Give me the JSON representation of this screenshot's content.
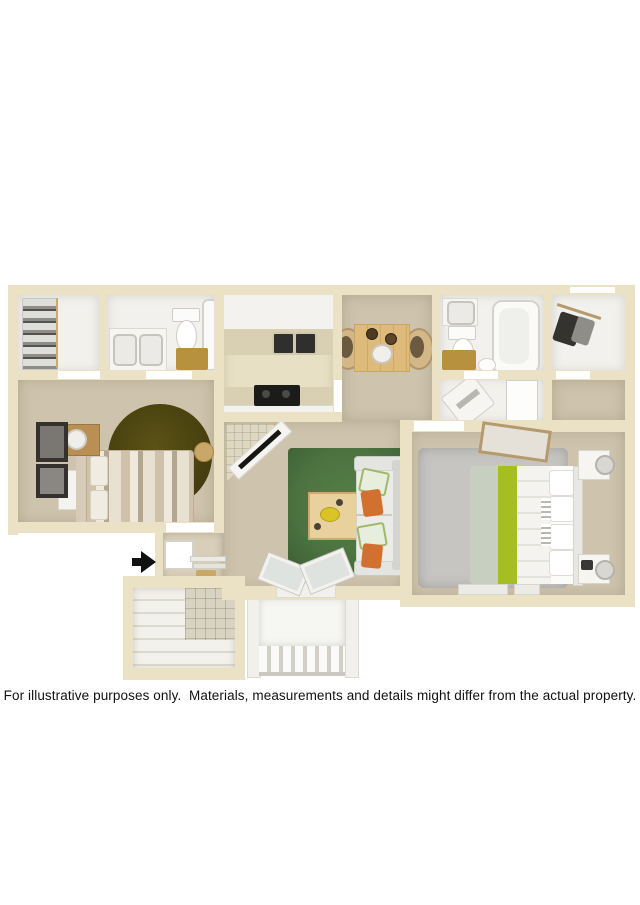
{
  "disclaimer": {
    "text": "For illustrative purposes only.  Materials, measurements and details might differ from the actual property."
  },
  "palette": {
    "wall": "#ebe2c6",
    "floor_tan": "#cec3ac",
    "floor_entry": "#d8ceba",
    "floor_tile_kitchen": "#e8e0c5",
    "floor_white": "#f2f1ed",
    "counter_beige": "#d9d0b4",
    "rug_green": "#4d7440",
    "rug_olive": "#453d0e",
    "rug_gray": "#c6c5c1",
    "bed2_chartreuse": "#a6be21",
    "bed2_sage": "#c7cfc0",
    "pillow_orange": "#d2712f",
    "wood": "#debb7b",
    "wood_dark": "#b98f54",
    "bath_gold": "#b8913f",
    "appliance_black": "#1b1b19",
    "arrow_black": "#111111",
    "text": "#111111"
  },
  "floorplan": {
    "type": "3d-rendered-floor-plan",
    "rooms": [
      {
        "name": "reach-in-closet",
        "contents": [
          "shelving",
          "clothes"
        ]
      },
      {
        "name": "bathroom-1",
        "contents": [
          "double-sink-vanity",
          "toilet",
          "bathtub"
        ]
      },
      {
        "name": "kitchen",
        "contents": [
          "upper-cabinets",
          "double-sink",
          "countertop",
          "range"
        ]
      },
      {
        "name": "dining-area",
        "contents": [
          "wood-table",
          "two-wicker-chairs",
          "centerpiece"
        ]
      },
      {
        "name": "bathroom-2",
        "contents": [
          "sink-vanity",
          "toilet",
          "bathtub"
        ]
      },
      {
        "name": "walk-in-closet",
        "contents": [
          "hanging-rod",
          "clothes"
        ]
      },
      {
        "name": "laundry-nook",
        "contents": [
          "washer",
          "closet-door"
        ]
      },
      {
        "name": "bedroom-1",
        "contents": [
          "striped-bed",
          "round-olive-rug",
          "nightstand-with-lamp",
          "wall-art",
          "bench",
          "stool"
        ]
      },
      {
        "name": "living-room",
        "contents": [
          "green-area-rug",
          "coffee-table",
          "sofa-with-pillows",
          "corner-tv-console",
          "corner-fireplace"
        ]
      },
      {
        "name": "bedroom-2",
        "contents": [
          "bed-with-green-runner",
          "gray-area-rug",
          "two-nightstands-with-lamps",
          "leaning-mirror"
        ]
      },
      {
        "name": "entry",
        "contents": [
          "entry-door",
          "steps",
          "door-mat"
        ]
      },
      {
        "name": "storage-patio-room",
        "contents": [
          "tiled-wall",
          "plank-floor"
        ]
      },
      {
        "name": "deck",
        "contents": [
          "railing"
        ]
      }
    ],
    "icons": [
      {
        "name": "entry-arrow-icon",
        "meaning": "unit entrance direction",
        "glyph": "right-arrow"
      }
    ]
  }
}
